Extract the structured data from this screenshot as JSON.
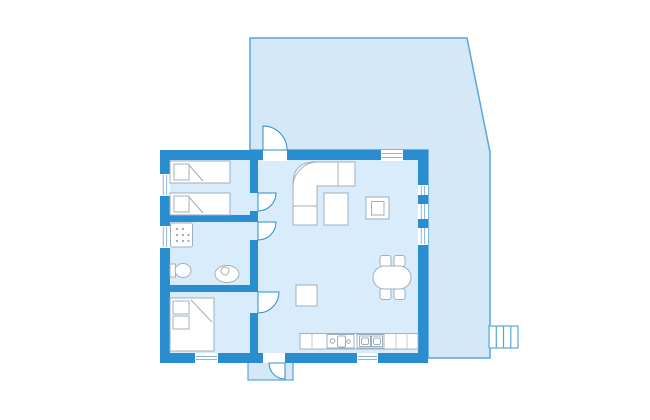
{
  "colors": {
    "background": "#ffffff",
    "wall": "#2a8dcf",
    "room_fill": "#d9ecfb",
    "terrace_fill": "#d5e8f7",
    "terrace_stroke": "#58a6db",
    "door_fill": "#ffffff",
    "door_stroke": "#2a8dcf",
    "window_glass": "#ffffff",
    "window_line": "#8ab6dc",
    "furniture_fill": "#ffffff",
    "furniture_stroke": "#9fb0bc",
    "counter_divider": "#c3ccd4"
  },
  "floor_plan": {
    "type": "cottage-floor-plan",
    "rooms": [
      {
        "id": "bedroom-twin",
        "furniture": [
          "single-bed",
          "single-bed"
        ]
      },
      {
        "id": "bathroom",
        "furniture": [
          "shower",
          "toilet",
          "washbasin"
        ]
      },
      {
        "id": "bedroom-double",
        "furniture": [
          "double-bed"
        ]
      },
      {
        "id": "living-kitchen",
        "furniture": [
          "corner-sofa",
          "coffee-table",
          "wood-stove",
          "side-table",
          "dining-table",
          "chair",
          "chair",
          "chair",
          "chair",
          "kitchen-counter",
          "cooktop-unit",
          "double-sink"
        ]
      }
    ],
    "outdoor": {
      "areas": [
        "terrace",
        "entrance-porch"
      ],
      "features": [
        "terrace-steps",
        "terrace-door",
        "entrance-door"
      ]
    },
    "window_count": 7,
    "interior_door_count": 3,
    "exterior_door_count": 2
  }
}
